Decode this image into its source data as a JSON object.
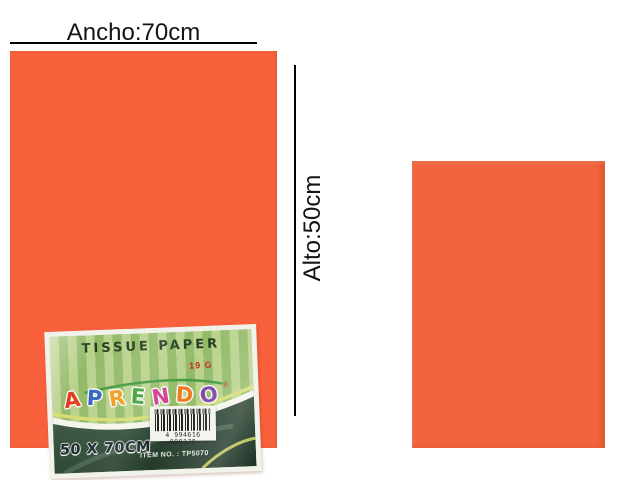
{
  "canvas": {
    "background": "#ffffff"
  },
  "annotations": {
    "width_text": "Ancho:70cm",
    "height_text": "Alto:50cm",
    "line_color": "#000000"
  },
  "product": {
    "large_sheet_color": "#f8613c",
    "small_sheet_color": "#f2643d"
  },
  "label": {
    "title": "TISSUE PAPER",
    "weight": "19 G",
    "brand": {
      "name": "APRENDO",
      "letters": [
        {
          "ch": "A",
          "color": "#e23b1c"
        },
        {
          "ch": "P",
          "color": "#2f62c4"
        },
        {
          "ch": "R",
          "color": "#f09c1e"
        },
        {
          "ch": "E",
          "color": "#3f9e38"
        },
        {
          "ch": "N",
          "color": "#d23a92"
        },
        {
          "ch": "D",
          "color": "#ee7a1f"
        },
        {
          "ch": "O",
          "color": "#7a3fa8"
        }
      ],
      "registered_mark": "®",
      "arc_color": "#3f9a3f"
    },
    "size_text": "50 X 70CM",
    "item_no": "ITEM NO. : TP5070",
    "barcode_digits": "4 994616 980178",
    "stripe_colors": [
      "#b9d28c",
      "#93ba68"
    ],
    "band_colors": [
      "#49684f",
      "#1c3023"
    ],
    "swoosh_colors": [
      "#d6dc72",
      "#f4f6ec"
    ]
  }
}
